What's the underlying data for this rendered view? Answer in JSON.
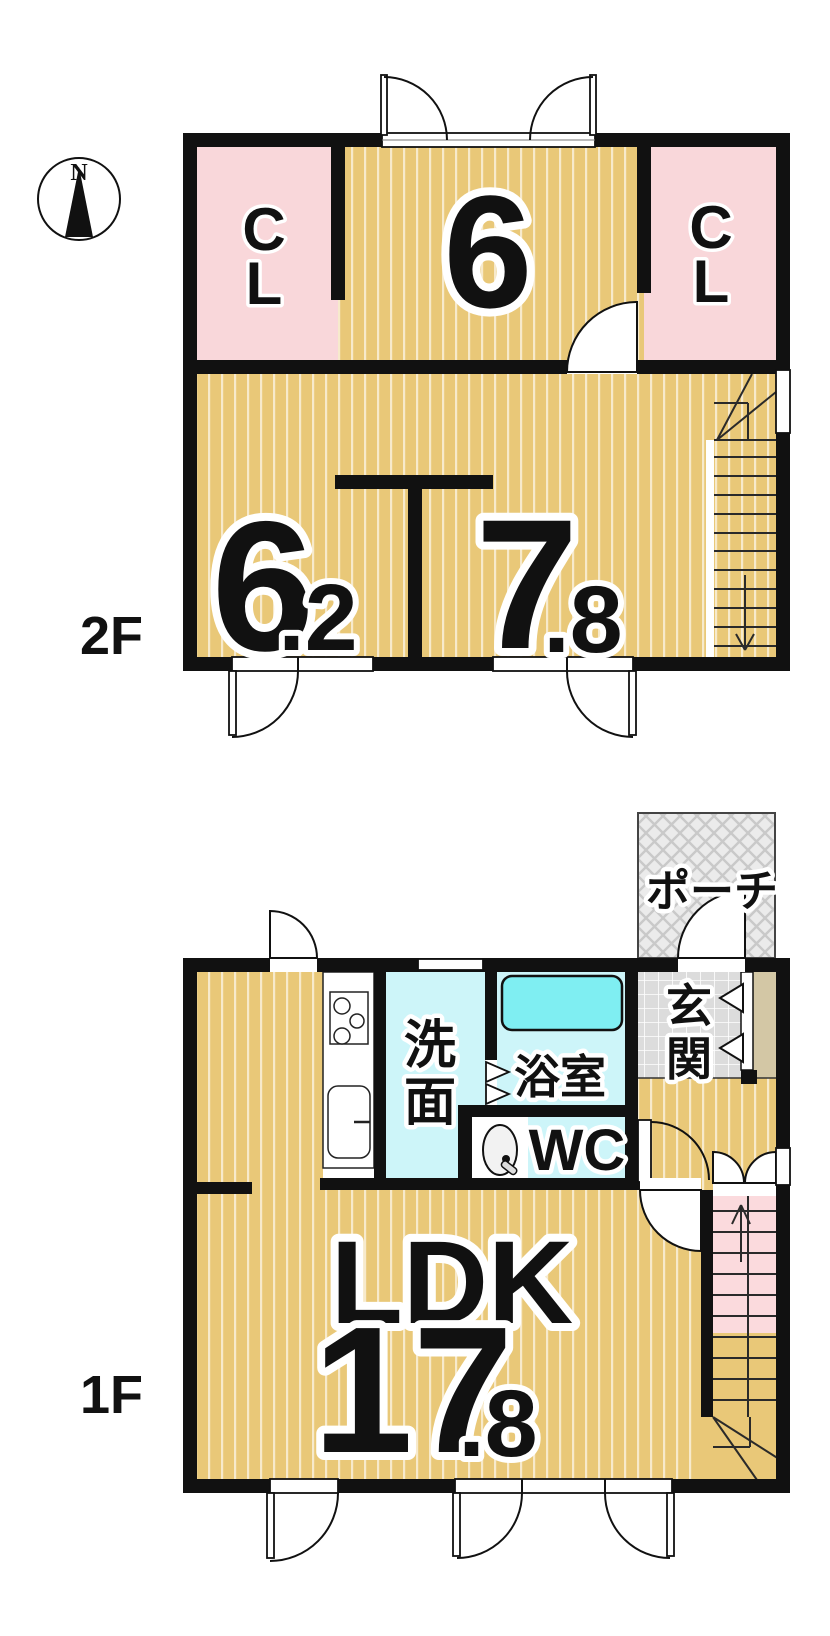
{
  "compass": {
    "north_label": "N"
  },
  "floor_2f": {
    "label": "2F",
    "closet_left_label": "CL",
    "closet_right_label": "CL",
    "room_top_area": "6",
    "room_left_area_whole": "6",
    "room_left_area_fraction": ".2",
    "room_right_area_whole": "7",
    "room_right_area_fraction": ".8"
  },
  "floor_1f": {
    "label": "1F",
    "porch_label": "ポーチ",
    "entrance_label": "玄関",
    "washroom_label": "洗面",
    "bathroom_label": "浴室",
    "wc_label": "WC",
    "ldk_name": "LDK",
    "ldk_area_whole": "17",
    "ldk_area_fraction": ".8"
  },
  "colors": {
    "tatami": "#e9c878",
    "stripe": "#ffffff",
    "closet_pink": "#f9d7da",
    "stair_pink": "#fbdadd",
    "water_cyan": "#cdf5f9",
    "bathtub_cyan": "#7feef2",
    "porch_gray": "#ebebeb",
    "porch_hatch": "#c9c9c9",
    "tile_gray": "#dcdcdc",
    "cabinet_beige": "#d3c7a5",
    "wall_black": "#111111"
  }
}
